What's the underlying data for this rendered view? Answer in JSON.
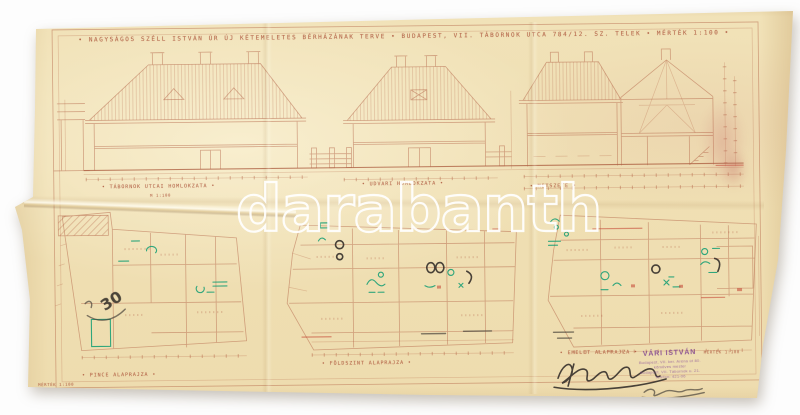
{
  "photo": {
    "watermark_text": "darabanth"
  },
  "sheet": {
    "title": "• NAGYSÁGOS SZÉLL ISTVÁN ÚR ÚJ KÉTEMELETES BÉRHÁZÁNAK TERVE • BUDAPEST, VII. TÁBORNOK UTCA 784/12. SZ. TELEK • MÉRTÉK 1:100 •",
    "captions": {
      "left_elevation": "• TÁBORNOK UTCAI HOMLOKZATA •",
      "middle_elevation": "• UDVARI HOMLOKZATA •",
      "section": "• METSZETE •",
      "plan_basement": "• PINCE ALAPRAJZA •",
      "plan_ground": "• FÖLDSZINT ALAPRAJZA •",
      "plan_upper": "• EMELET ALAPRAJZA •"
    },
    "notes": {
      "elevation_scale": "M 1:100",
      "plan_upper_scale": "MÉRTÉK 1:100",
      "corner_scale": "MÉRTÉK 1:100",
      "pencil_note": "30"
    },
    "stamp": {
      "name": "VÁRI ISTVÁN",
      "line2": "Budapest, VII. ker. Aréna út 80.",
      "line3": "kőműves mester",
      "line4": "Budapest, VII. Tábornok u. 21.",
      "line5": "Telefon: 421-06"
    },
    "signatures": {
      "ink": "Fáy J. István",
      "pencil": "Vári István"
    }
  },
  "colors": {
    "background": "#ffffff",
    "paper": "#f0e0b4",
    "drawing_ink": "#b25f43",
    "annotation_green": "#169e74",
    "accent_red": "#c2402f",
    "stamp_purple": "#7c3f8f",
    "pencil": "#4a443c",
    "stain_pink": "#d08c8c"
  }
}
